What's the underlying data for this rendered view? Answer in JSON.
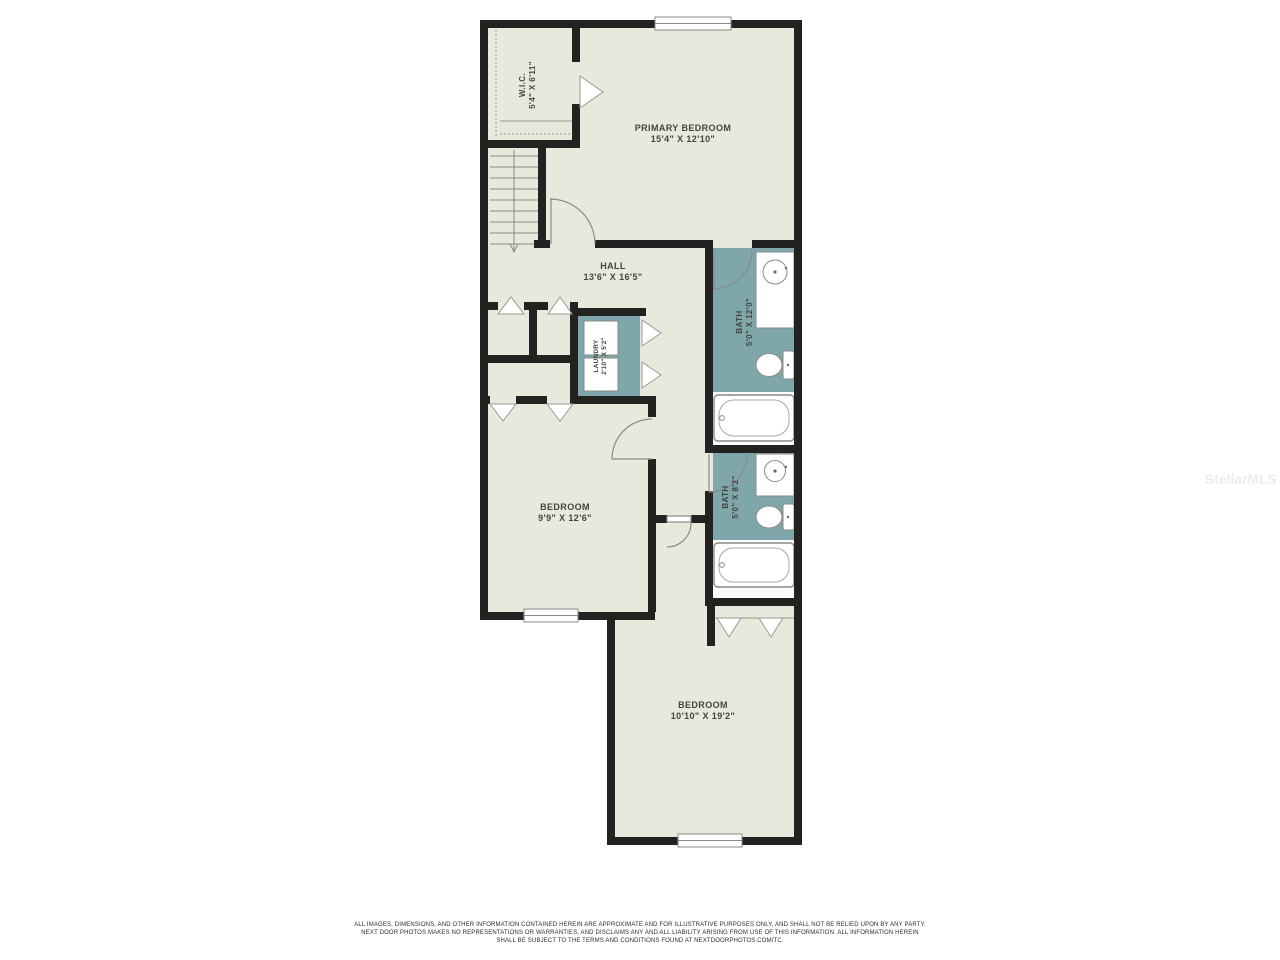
{
  "plan": {
    "rooms": [
      {
        "id": "primary-bedroom",
        "label": "PRIMARY BEDROOM",
        "dims": "15'4\" X 12'10\""
      },
      {
        "id": "wic",
        "label": "W.I.C.",
        "dims": "5'4\" X 6'11\""
      },
      {
        "id": "hall",
        "label": "HALL",
        "dims": "13'6\" X 16'5\""
      },
      {
        "id": "bath-upper",
        "label": "BATH",
        "dims": "5'0\" X 12'0\""
      },
      {
        "id": "laundry",
        "label": "LAUNDRY",
        "dims": "2'10\" X 5'2\""
      },
      {
        "id": "bedroom-mid",
        "label": "BEDROOM",
        "dims": "9'9\" X 12'6\""
      },
      {
        "id": "bath-lower",
        "label": "BATH",
        "dims": "5'0\" X 8'2\""
      },
      {
        "id": "bedroom-lower",
        "label": "BEDROOM",
        "dims": "10'10\" X 19'2\""
      }
    ],
    "colors": {
      "wall": "#222220",
      "floor": "#e9e8dc",
      "wet_floor": "#7fa6ab",
      "fixture_line": "#8a8a86",
      "label_text": "#45453f"
    }
  },
  "watermark": "StellarMLS",
  "disclaimer": {
    "lines": [
      "ALL IMAGES, DIMENSIONS, AND OTHER INFORMATION CONTAINED HEREIN ARE APPROXIMATE AND FOR ILLUSTRATIVE PURPOSES ONLY, AND SHALL NOT BE RELIED UPON BY ANY PARTY.",
      "NEXT DOOR PHOTOS MAKES NO REPRESENTATIONS OR WARRANTIES, AND DISCLAIMS ANY AND ALL LIABILITY ARISING FROM USE OF THIS INFORMATION. ALL INFORMATION HEREIN",
      "SHALL BE SUBJECT TO THE TERMS AND CONDITIONS FOUND AT NEXTDOORPHOTOS.COM/TC."
    ]
  }
}
